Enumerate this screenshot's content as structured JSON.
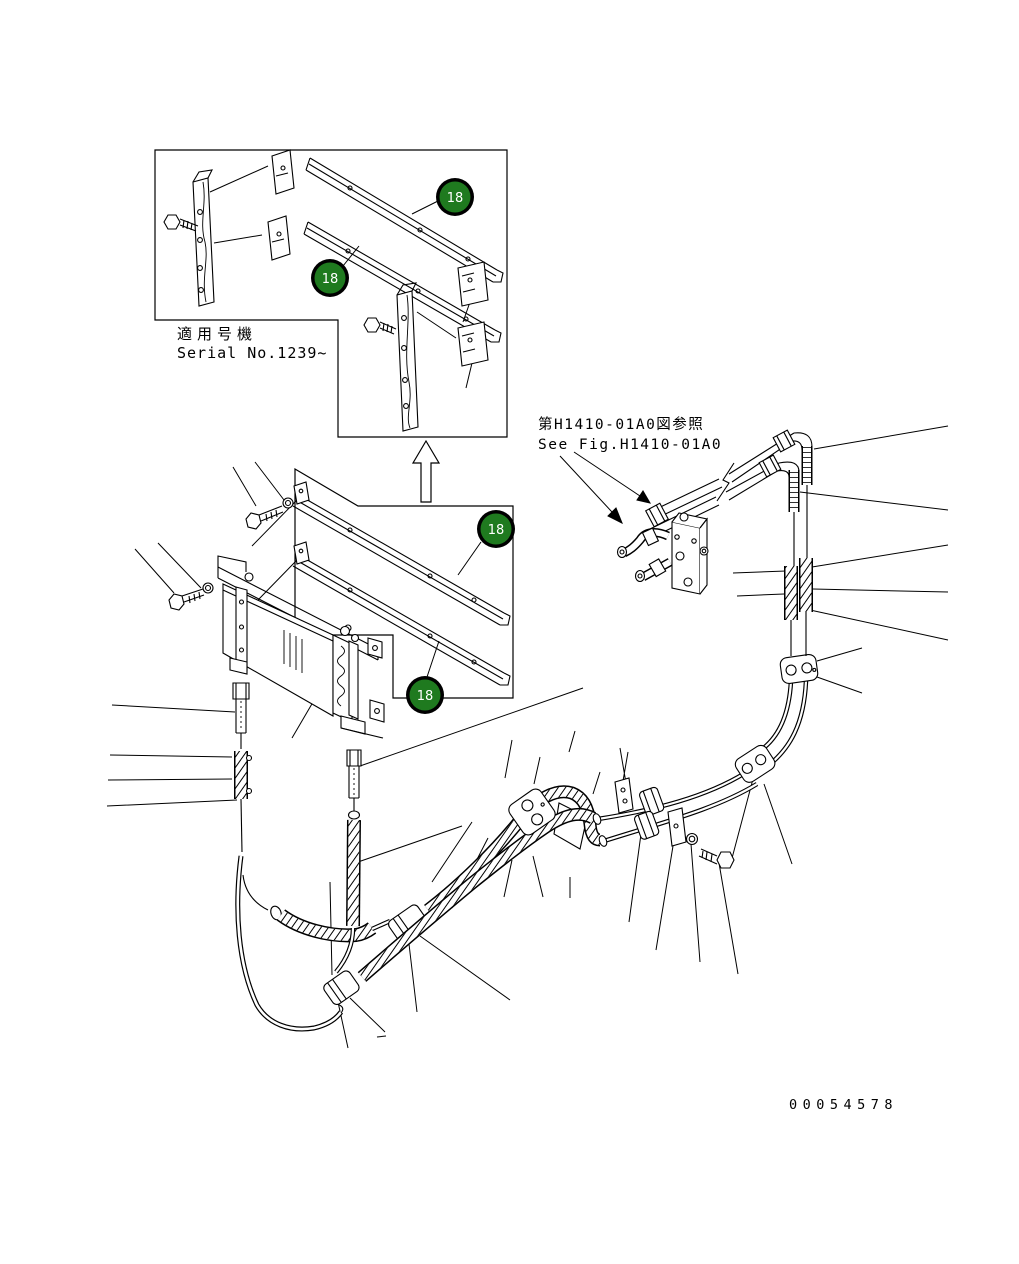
{
  "diagram": {
    "type": "exploded-parts-drawing",
    "background": "#ffffff",
    "line_color": "#000000",
    "badge": {
      "fill": "#1f7a1f",
      "ring": "#000000",
      "text_color": "#ffffff"
    },
    "callouts": [
      {
        "value": "18"
      },
      {
        "value": "18"
      },
      {
        "value": "18"
      },
      {
        "value": "18"
      }
    ],
    "notes": {
      "applicable_serial_jp": "適用号機",
      "applicable_serial_en": "Serial No.1239~",
      "reference_jp": "第H1410-01A0図参照",
      "reference_en": "See Fig.H1410-01A0"
    },
    "drawing_number": "00054578"
  }
}
